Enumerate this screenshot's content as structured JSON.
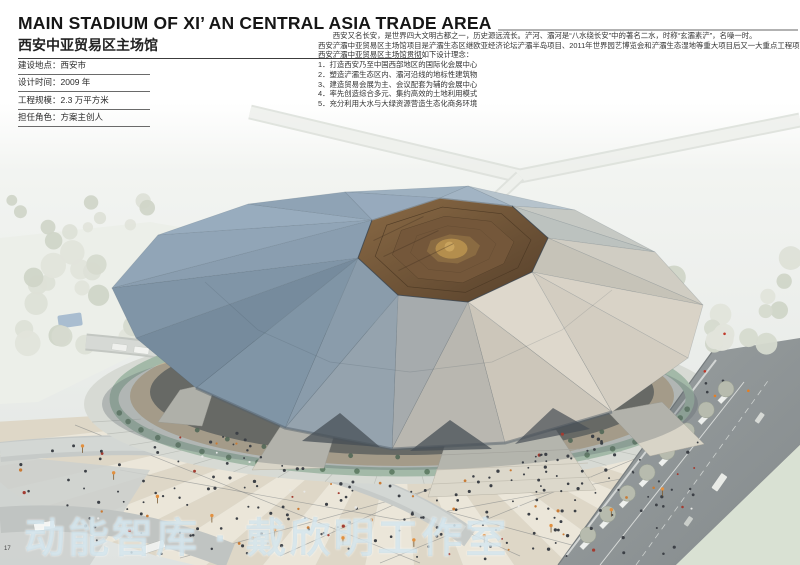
{
  "page": {
    "number": "17",
    "title": "MAIN STADIUM OF XI’ AN CENTRAL ASIA TRADE AREA",
    "subtitle_cn": "西安中亚贸易区主场馆",
    "watermark": "动能智库 · 戴欣明工作室"
  },
  "project_info": {
    "separator": "：",
    "items": [
      {
        "label": "建设地点",
        "value": "西安市"
      },
      {
        "label": "设计时间",
        "value": "2009 年"
      },
      {
        "label": "工程规模",
        "value": "2.3 万平方米"
      },
      {
        "label": "担任角色",
        "value": "方案主创人"
      }
    ]
  },
  "description": {
    "lines": [
      "　　西安又名长安，是世界四大文明古都之一，历史源远流长。浐河、灞河是“八水绕长安”中的著名二水，时称“玄灞素浐”，名噪一时。",
      "西安浐灞中亚贸易区主场馆项目是浐灞生态区继欧亚经济论坛浐灞半岛项目、2011年世界园艺博览会和浐灞生态湿地等重大项目后又一大重点工程项目。",
      "西安浐灞中亚贸易区主场馆贯彻如下设计理念：",
      "1．打造西安乃至中国西部地区的国际化会展中心",
      "2．塑造浐灞生态区内、灞河沿线的地标性建筑物",
      "3、建造贸易会展为主、会议配套为辅的会展中心",
      "4．率先创造综合多元、集约高效的土地利用模式",
      "5．充分利用大水与大绿资源营造生态化商务环境"
    ]
  },
  "rendering": {
    "label": "stadium-aerial-rendering",
    "colors": {
      "dome_blue": "#869cae",
      "dome_warm": "#d5cfc3",
      "crater_brown": "#6e5439",
      "crater_gold": "#b8924f",
      "green_ring": "#a3b9a8",
      "plaza_beige": "#ded7c7",
      "plaza_cream": "#ebe6d9",
      "road_gray": "#9aa0a1",
      "people_dark": "#3c4046",
      "people_orange": "#c97b35",
      "lamp_orange": "#e2903f"
    }
  }
}
